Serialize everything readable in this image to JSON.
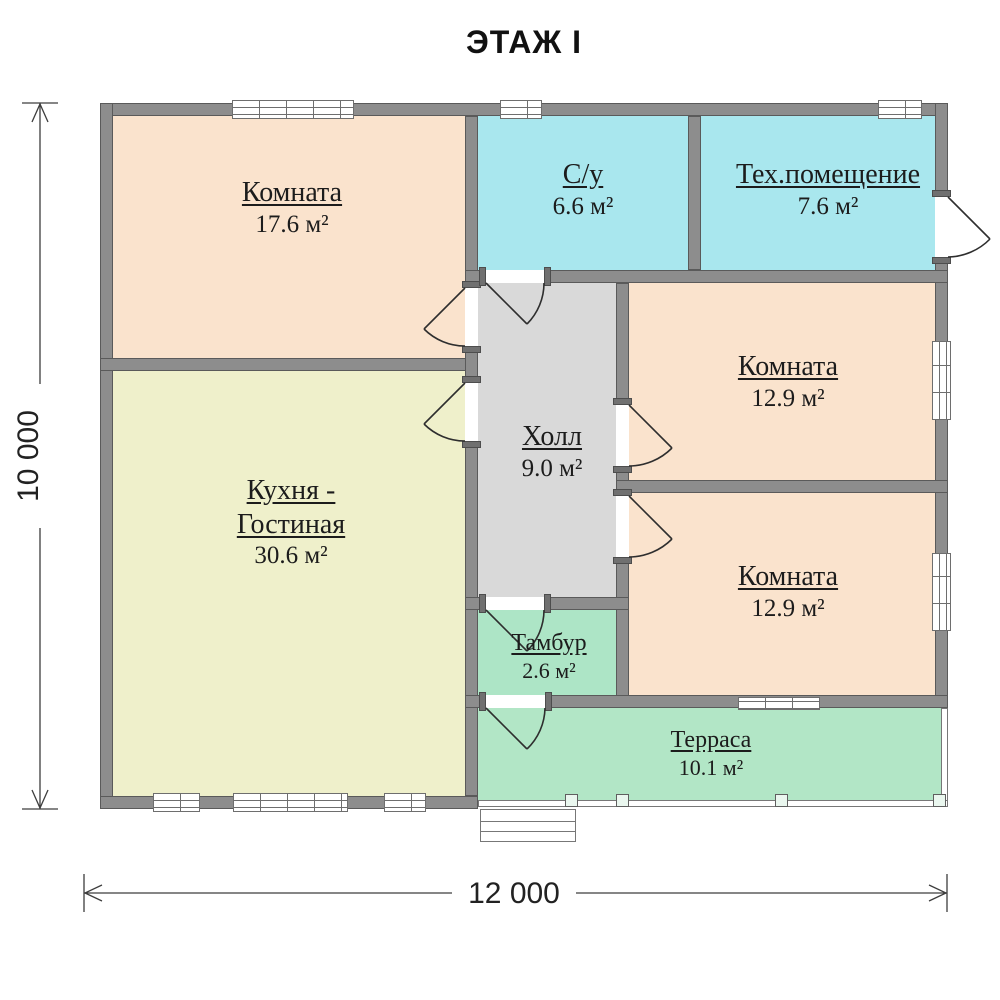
{
  "title": "ЭТАЖ I",
  "dimensions": {
    "width": "12 000",
    "height": "10 000"
  },
  "rooms": {
    "room1": {
      "name": "Комната",
      "area": "17.6 м²",
      "fill": "#fae3cd"
    },
    "bathroom": {
      "name": "С/у",
      "area": "6.6 м²",
      "fill": "#a9e7ee"
    },
    "tech": {
      "name": "Тех.помещение",
      "area": "7.6 м²",
      "fill": "#a9e7ee"
    },
    "kitchen": {
      "name_line1": "Кухня -",
      "name_line2": "Гостиная",
      "area": "30.6 м²",
      "fill": "#eff0cb"
    },
    "hall": {
      "name": "Холл",
      "area": "9.0 м²",
      "fill": "#d9d9d9"
    },
    "room2": {
      "name": "Комната",
      "area": "12.9 м²",
      "fill": "#fae3cd"
    },
    "room3": {
      "name": "Комната",
      "area": "12.9 м²",
      "fill": "#fae3cd"
    },
    "tambour": {
      "name": "Тамбур",
      "area": "2.6 м²",
      "fill": "#ade5c6"
    },
    "terrace": {
      "name": "Терраса",
      "area": "10.1 м²",
      "fill": "#b2e6c6"
    }
  },
  "wall_color": "#8d8d8d"
}
